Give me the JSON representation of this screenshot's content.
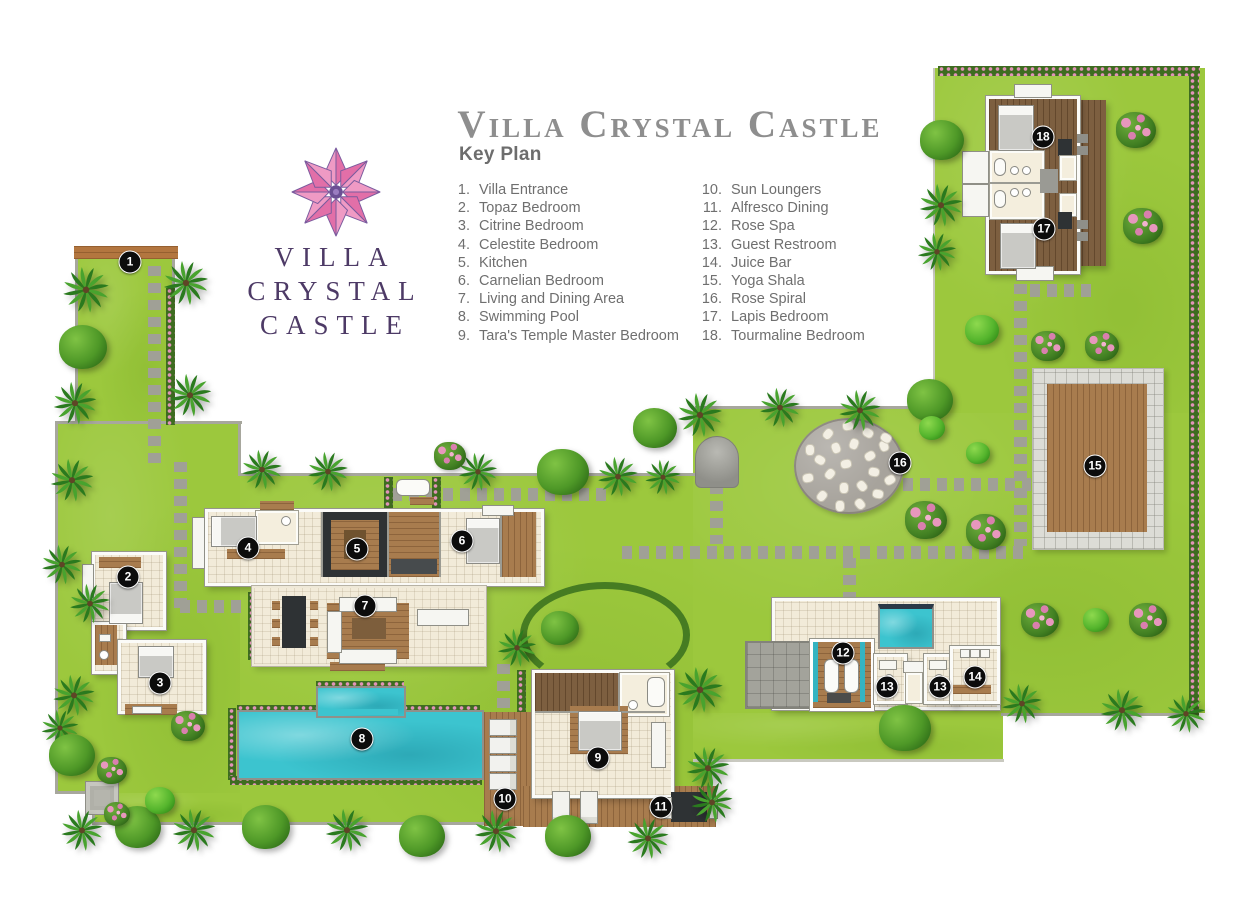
{
  "title": "Villa Crystal Castle",
  "logo": {
    "line1": "VILLA",
    "line2": "CRYSTAL",
    "line3": "CASTLE",
    "flower_icon": "eight-petal-lotus"
  },
  "key_plan": {
    "heading": "Key Plan",
    "items": [
      {
        "number": "1.",
        "label": "Villa Entrance"
      },
      {
        "number": "2.",
        "label": "Topaz Bedroom"
      },
      {
        "number": "3.",
        "label": "Citrine Bedroom"
      },
      {
        "number": "4.",
        "label": "Celestite Bedroom"
      },
      {
        "number": "5.",
        "label": "Kitchen"
      },
      {
        "number": "6.",
        "label": "Carnelian Bedroom"
      },
      {
        "number": "7.",
        "label": "Living and Dining Area"
      },
      {
        "number": "8.",
        "label": "Swimming Pool"
      },
      {
        "number": "9.",
        "label": "Tara's Temple Master Bedroom"
      },
      {
        "number": "10.",
        "label": "Sun Loungers"
      },
      {
        "number": "11.",
        "label": "Alfresco Dining"
      },
      {
        "number": "12.",
        "label": "Rose Spa"
      },
      {
        "number": "13.",
        "label": "Guest Restroom"
      },
      {
        "number": "14.",
        "label": "Juice Bar"
      },
      {
        "number": "15.",
        "label": "Yoga Shala"
      },
      {
        "number": "16.",
        "label": "Rose Spiral"
      },
      {
        "number": "17.",
        "label": "Lapis Bedroom"
      },
      {
        "number": "18.",
        "label": "Tourmaline Bedroom"
      }
    ]
  },
  "map": {
    "markers": [
      {
        "number": "1",
        "label": "Villa Entrance",
        "x": 130,
        "y": 262
      },
      {
        "number": "2",
        "label": "Topaz Bedroom",
        "x": 128,
        "y": 577
      },
      {
        "number": "3",
        "label": "Citrine Bedroom",
        "x": 160,
        "y": 683
      },
      {
        "number": "4",
        "label": "Celestite Bedroom",
        "x": 248,
        "y": 548
      },
      {
        "number": "5",
        "label": "Kitchen",
        "x": 357,
        "y": 549
      },
      {
        "number": "6",
        "label": "Carnelian Bedroom",
        "x": 462,
        "y": 541
      },
      {
        "number": "7",
        "label": "Living and Dining Area",
        "x": 365,
        "y": 606
      },
      {
        "number": "8",
        "label": "Swimming Pool",
        "x": 362,
        "y": 739
      },
      {
        "number": "9",
        "label": "Tara's Temple Master Bedroom",
        "x": 598,
        "y": 758
      },
      {
        "number": "10",
        "label": "Sun Loungers",
        "x": 505,
        "y": 799
      },
      {
        "number": "11",
        "label": "Alfresco Dining",
        "x": 661,
        "y": 807
      },
      {
        "number": "12",
        "label": "Rose Spa",
        "x": 843,
        "y": 653
      },
      {
        "number": "13",
        "label": "Guest Restroom",
        "x": 887,
        "y": 687
      },
      {
        "number": "13",
        "label": "Guest Restroom",
        "x": 940,
        "y": 687
      },
      {
        "number": "14",
        "label": "Juice Bar",
        "x": 975,
        "y": 677
      },
      {
        "number": "15",
        "label": "Yoga Shala",
        "x": 1095,
        "y": 466
      },
      {
        "number": "16",
        "label": "Rose Spiral",
        "x": 900,
        "y": 463
      },
      {
        "number": "17",
        "label": "Lapis Bedroom",
        "x": 1044,
        "y": 229
      },
      {
        "number": "18",
        "label": "Tourmaline Bedroom",
        "x": 1043,
        "y": 137
      }
    ]
  },
  "colors": {
    "grass": "#9cc83d",
    "pool": "#3cc4cf",
    "wood": "#a87c4e",
    "hedge_green": "#3e6c20",
    "flower_pink": "#e293b8",
    "logo_purple": "#4d3a66",
    "title_gray": "#8e8e8e",
    "marker": "#0c0c0c"
  }
}
